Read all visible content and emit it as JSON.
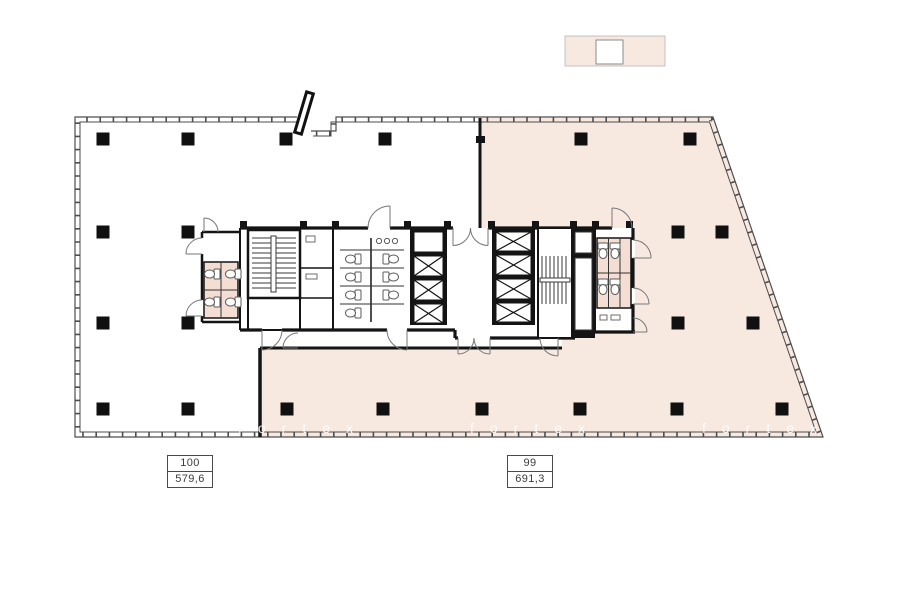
{
  "units": [
    {
      "number": "100",
      "area": "579,6"
    },
    {
      "number": "99",
      "area": "691,3"
    }
  ],
  "watermark": {
    "text": "fortex"
  },
  "colors": {
    "unit_99_fill": "#f8e9e0",
    "stall_fill": "#f4ddd2",
    "wall": "#141414",
    "thin_line": "#6e6e6e"
  }
}
